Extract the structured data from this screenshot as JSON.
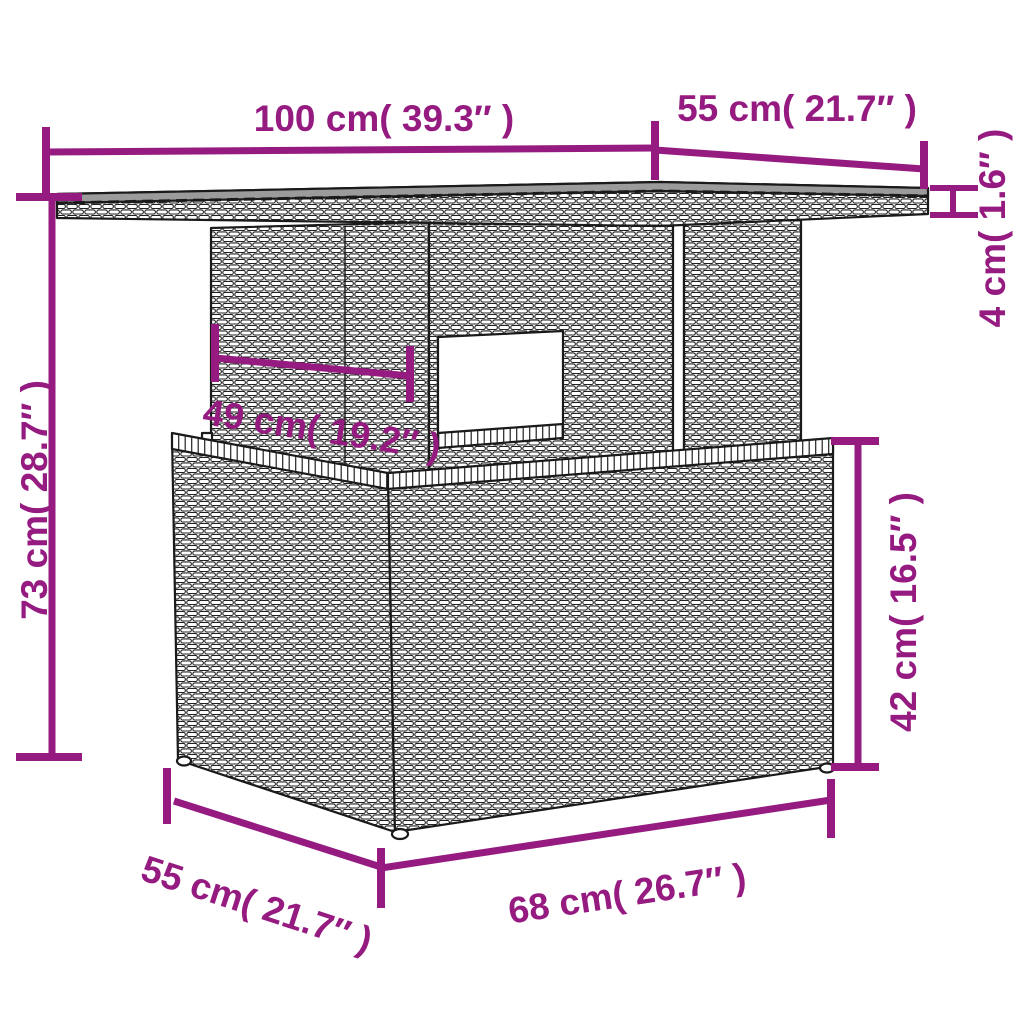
{
  "title": "Rattan garden table dimension diagram",
  "colors": {
    "accent": "#951b81",
    "outline": "#1a1a1a",
    "glass_top": "#9b9b9b",
    "background": "#ffffff"
  },
  "dimensions": {
    "top_width": {
      "cm": 100,
      "inch": 39.3,
      "label": "100 cm( 39.3″ )"
    },
    "top_depth": {
      "cm": 55,
      "inch": 21.7,
      "label": "55 cm( 21.7″ )"
    },
    "top_thickness": {
      "cm": 4,
      "inch": 1.6,
      "label": "4 cm( 1.6″ )"
    },
    "overall_height": {
      "cm": 73,
      "inch": 28.7,
      "label": "73 cm( 28.7″ )"
    },
    "understructure_width": {
      "cm": 49,
      "inch": 19.2,
      "label": "49 cm( 19.2″ )"
    },
    "base_height": {
      "cm": 42,
      "inch": 16.5,
      "label": "42 cm( 16.5″ )"
    },
    "base_depth": {
      "cm": 55,
      "inch": 21.7,
      "label": "55 cm( 21.7″ )"
    },
    "base_width": {
      "cm": 68,
      "inch": 26.7,
      "label": "68 cm( 26.7″ )"
    }
  }
}
